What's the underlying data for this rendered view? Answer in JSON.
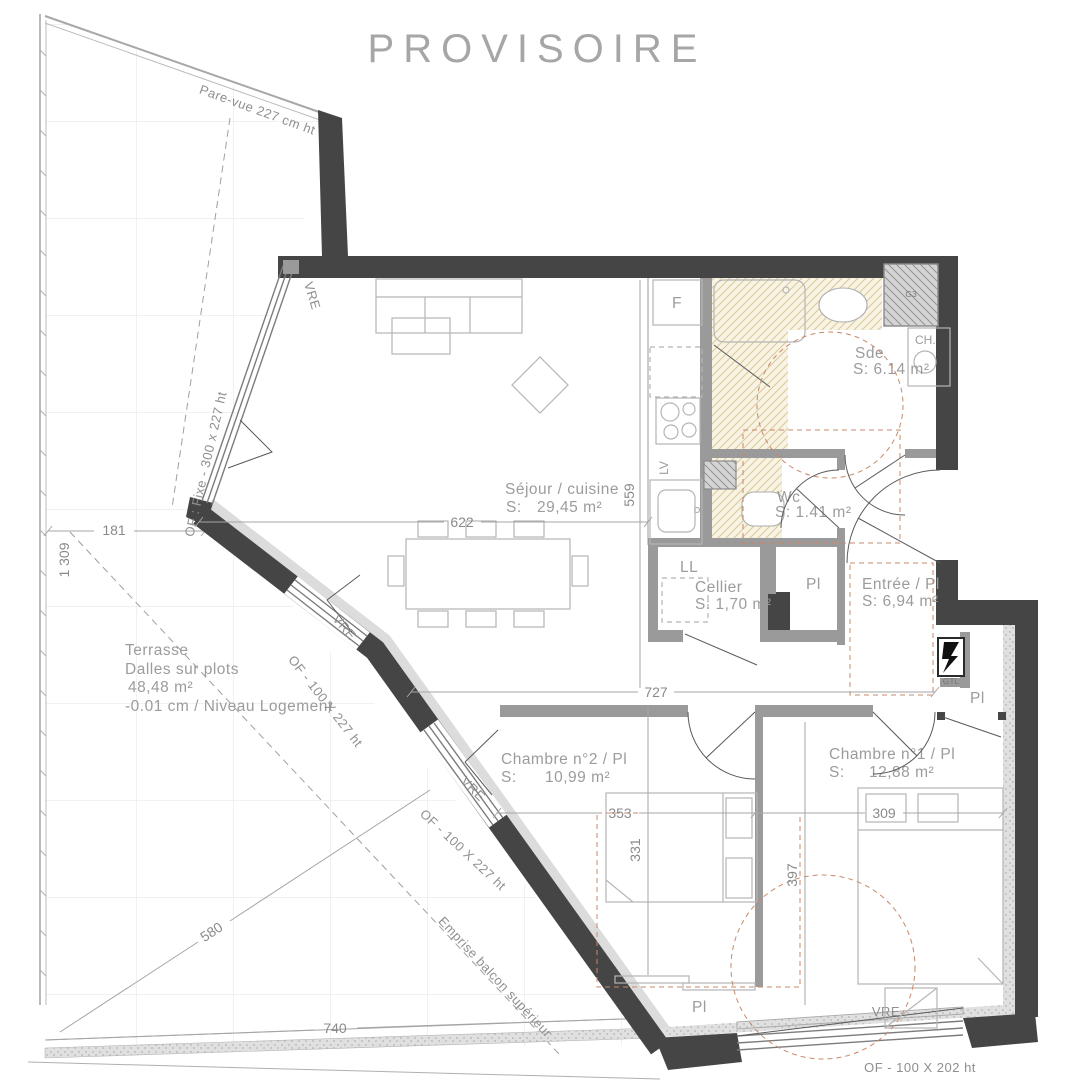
{
  "title": "PROVISOIRE",
  "rooms": {
    "sejour": {
      "name": "Séjour / cuisine",
      "area_prefix": "S:",
      "area": "29,45 m²"
    },
    "sde": {
      "name": "Sde",
      "area": "S: 6.14 m²"
    },
    "wc": {
      "name": "Wc",
      "area": "S: 1.41 m²"
    },
    "cellier": {
      "name": "Cellier",
      "area": "S: 1,70 m²"
    },
    "entree": {
      "name": "Entrée / Pl",
      "area": "S: 6,94 m²"
    },
    "chambre2": {
      "name": "Chambre n°2 / Pl",
      "area_prefix": "S:",
      "area": "10,99 m²"
    },
    "chambre1": {
      "name": "Chambre n°1 / Pl",
      "area_prefix": "S:",
      "area": "12,88 m²"
    }
  },
  "terrasse": {
    "name": "Terrasse",
    "line2": "Dalles sur plots",
    "line3": "48,48 m²",
    "line4": "-0.01 cm / Niveau Logement"
  },
  "window_labels": {
    "pare_vue": "Pare-vue 227 cm ht",
    "of_fixe": "OF : Fixe - 300 x 227 ht",
    "vre": "VRE",
    "of_227": "OF - 100 X 227 ht",
    "of_202": "OF - 100 X 202 ht"
  },
  "annotations": {
    "emprise": "Emprise balcon supérieur"
  },
  "equipment": {
    "fridge": "F",
    "dishwasher": "LV",
    "washer": "LL",
    "water_heater": "CH.",
    "duct": "G3",
    "electrical": "GTL",
    "closet": "Pl"
  },
  "dims": {
    "d1309": "1 309",
    "d181": "181",
    "d622": "622",
    "d559": "559",
    "d727": "727",
    "d353": "353",
    "d331": "331",
    "d309": "309",
    "d397": "397",
    "d580": "580",
    "d740": "740"
  },
  "colors": {
    "wall_dark": "#454545",
    "wall_gray": "#9a9a9a",
    "hatch_beige_bg": "#f8f3e2",
    "hatch_beige_line": "#d8c89c",
    "hatch_gray_bg": "#d4d4d4",
    "hatch_gray_line": "#949494",
    "clearance_red": "#c9886a",
    "label_gray": "#9c9c9c",
    "dim_gray": "#8a8a8a",
    "grid": "#e3e3e3"
  }
}
